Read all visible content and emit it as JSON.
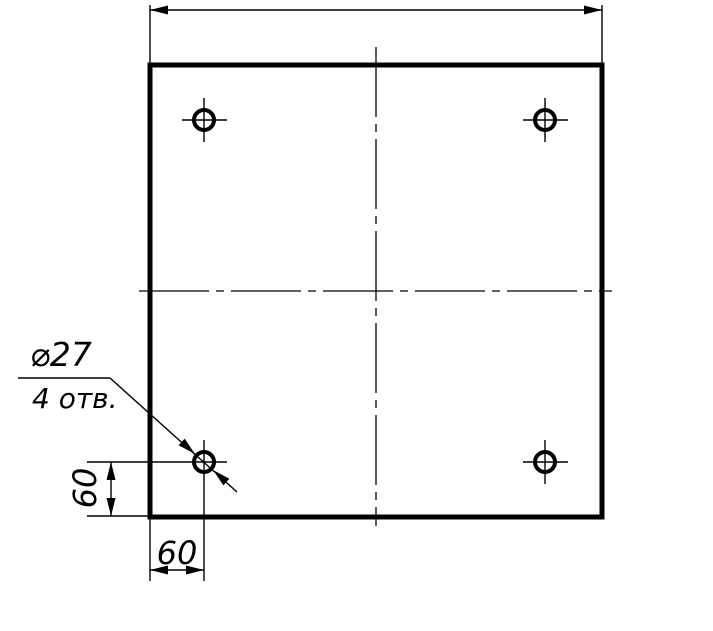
{
  "drawing": {
    "kind": "engineering-drawing",
    "background_color": "#ffffff",
    "line_color": "#000000",
    "callout": {
      "diameter": "⌀27",
      "count": "4 отв."
    },
    "dimensions": {
      "hole_offset_vertical": "60",
      "hole_offset_horizontal": "60",
      "overall_width_label": ""
    },
    "holes": {
      "count": 4
    }
  }
}
